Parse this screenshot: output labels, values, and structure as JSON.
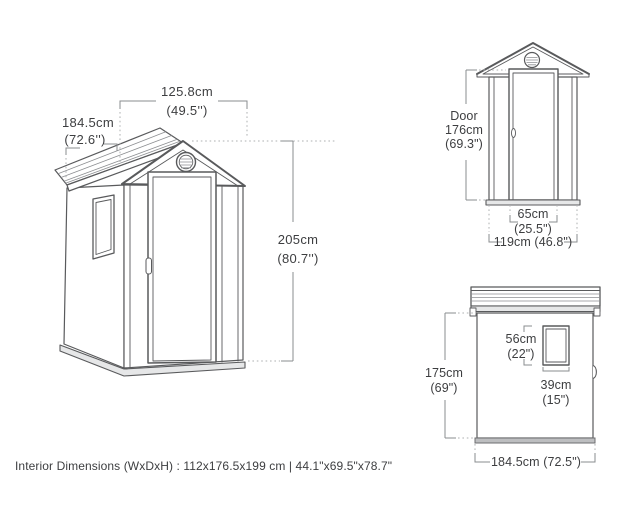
{
  "iso_view": {
    "width": "125.8cm",
    "width_in": "(49.5'')",
    "depth": "184.5cm",
    "depth_in": "(72.6'')",
    "height": "205cm",
    "height_in": "(80.7'')"
  },
  "front_view": {
    "door_line1": "Door",
    "door_line2": "176cm",
    "door_line3": "(69.3\")",
    "door_width": "65cm",
    "door_width_in": "(25.5\")",
    "base_width": "119cm (46.8\")"
  },
  "side_view": {
    "window_height": "56cm",
    "window_height_in": "(22\")",
    "wall_height": "175cm",
    "wall_height_in": "(69\")",
    "window_width": "39cm",
    "window_width_in": "(15\")",
    "base_depth": "184.5cm (72.5\")"
  },
  "footer": {
    "interior_dimensions": "Interior Dimensions (WxDxH) : 112x176.5x199 cm | 44.1\"x69.5\"x78.7\""
  },
  "colors": {
    "line": "#595a5c",
    "dimension": "#8a8c8f",
    "text": "#3d3e40"
  }
}
